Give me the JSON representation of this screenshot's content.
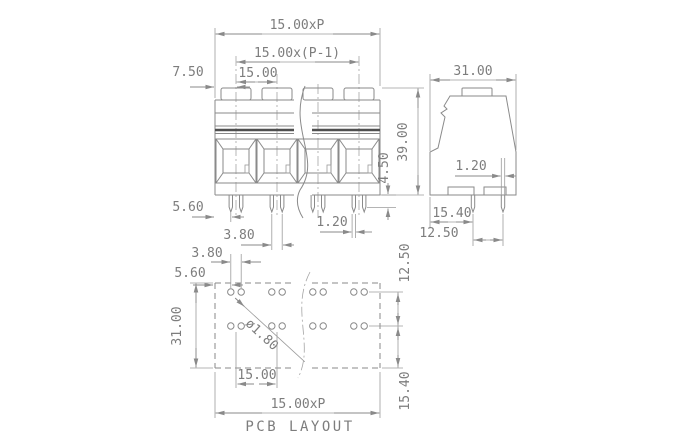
{
  "drawing": {
    "front_view": {
      "dim_pitch_total": "15.00xP",
      "dim_pitch_span": "15.00x(P-1)",
      "dim_pitch": "15.00",
      "dim_half_pitch": "7.50",
      "dim_edge_to_pin": "5.60",
      "dim_pin_pair_spacing": "3.80",
      "dim_pin_width": "1.20",
      "dim_pin_shoulder": "4.50"
    },
    "side_view": {
      "dim_depth": "31.00",
      "dim_height": "39.00",
      "dim_pin_width": "1.20",
      "dim_front_to_pin": "15.40",
      "dim_pin_row_spacing": "12.50"
    },
    "pcb_layout": {
      "caption": "PCB LAYOUT",
      "dim_hole_pair_spacing": "3.80",
      "dim_edge_to_hole": "5.60",
      "dim_depth": "31.00",
      "hole_diameter": "ø1.80",
      "dim_row_spacing": "12.50",
      "dim_row_to_edge": "15.40",
      "dim_pitch": "15.00",
      "dim_pitch_total": "15.00xP"
    },
    "colors": {
      "line": "#8a8a8a",
      "dark_band": "#4f4f4f",
      "text": "#7d7d7d",
      "background": "#ffffff"
    }
  }
}
